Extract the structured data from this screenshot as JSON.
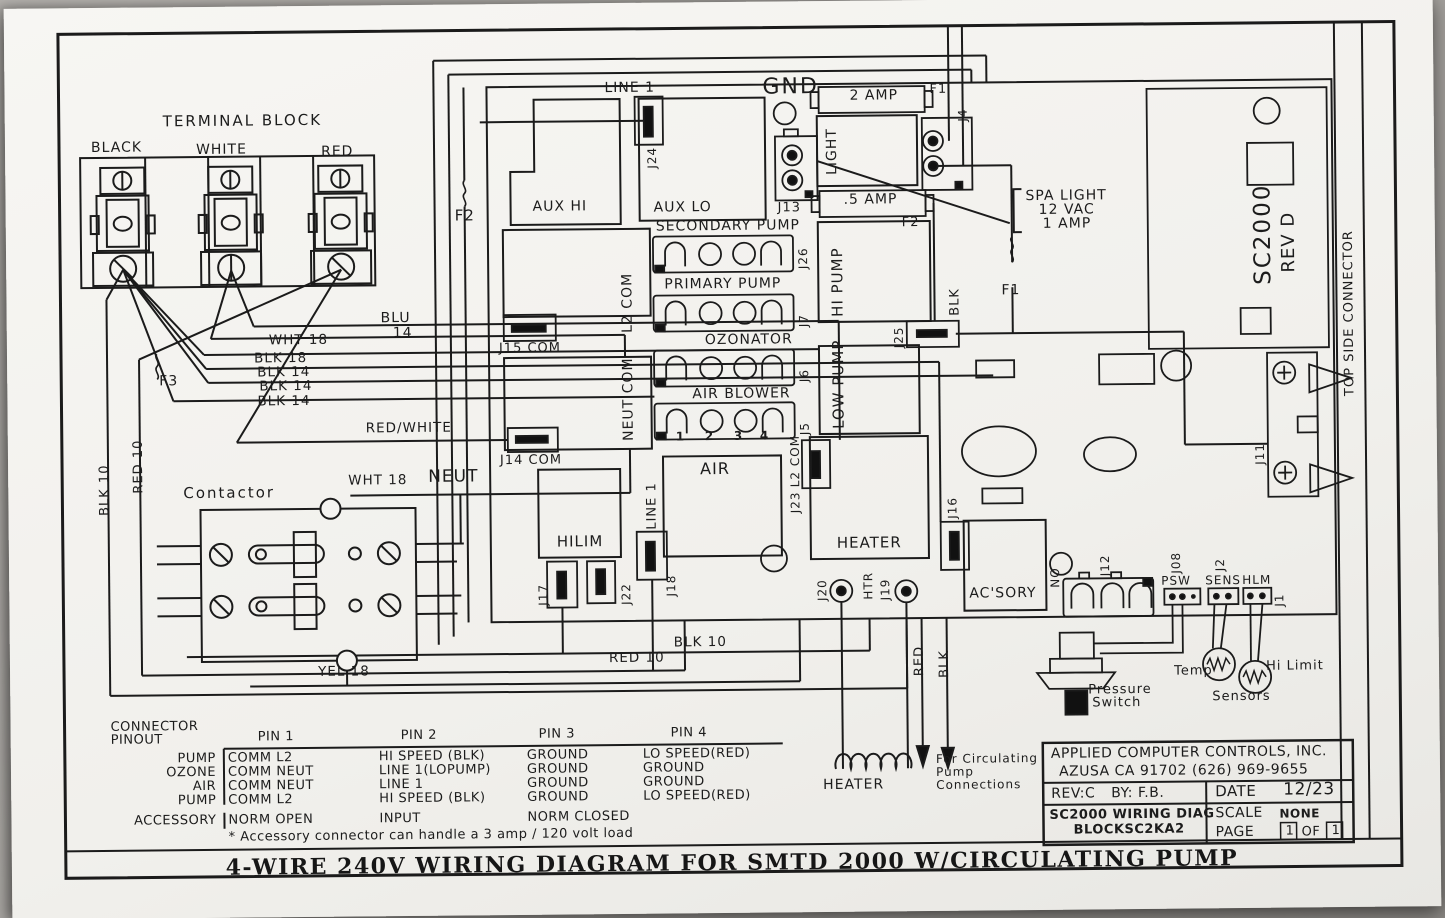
{
  "title_bar": "4-WIRE 240V WIRING DIAGRAM FOR SMTD 2000 W/CIRCULATING PUMP",
  "terminal_block": {
    "title": "TERMINAL BLOCK",
    "terminals": [
      "BLACK",
      "WHITE",
      "RED"
    ]
  },
  "board": {
    "gnd": "GND",
    "line1": "LINE 1",
    "j24": "J24",
    "aux_hi": "AUX HI",
    "aux_lo": "AUX LO",
    "f1": "F1",
    "f2": "F2",
    "f3": "F3",
    "fuse_2amp": "2 AMP",
    "fuse_half_amp": ".5 AMP",
    "j4": "J4",
    "light": "LIGHT",
    "j13": "J13",
    "spa_light_note": [
      "SPA LIGHT",
      "12 VAC",
      "1 AMP"
    ],
    "secondary_pump": "SECONDARY PUMP",
    "j26": "J26",
    "primary_pump": "PRIMARY PUMP",
    "j7": "J7",
    "ozonator": "OZONATOR",
    "j6": "J6",
    "air_blower": "AIR BLOWER",
    "j5": "J5",
    "pins": [
      "1",
      "2",
      "3",
      "4"
    ],
    "l2_com": "L2 COM",
    "j15_com": "J15 COM",
    "neut_com": "NEUT COM",
    "j14_com": "J14 COM",
    "hi_pump": "HI PUMP",
    "low_pump": "LOW PUMP",
    "j25": "J25",
    "sc2000": "SC2000",
    "rev_d": "REV D",
    "top_side_connector": "TOP SIDE CONNECTOR",
    "j11": "J11",
    "hilim": "HILIM",
    "j17": "J17",
    "j22": "J22",
    "j18": "J18",
    "air": "AIR",
    "j23": "J23",
    "heater": "HEATER",
    "j20": "J20",
    "htr": "HTR",
    "j19": "J19",
    "j16": "J16",
    "acsory": "AC'SORY",
    "no_label": "NO",
    "j12": "J12",
    "j08": "J08",
    "psw": "PSW",
    "j2": "J2",
    "sens": "SENS",
    "hlm": "HLM",
    "j1": "J1"
  },
  "wires": {
    "wht18": "WHT 18",
    "blk18": "BLK 18",
    "blk14": "BLK 14",
    "blu": "BLU",
    "blu_gauge": "14",
    "red_white": "RED/WHITE",
    "blk10": "BLK 10",
    "red10": "RED 10",
    "neut": "NEUT",
    "yel18": "YEL 18",
    "red": "RED",
    "blk": "BLK"
  },
  "contactor": {
    "label": "Contactor"
  },
  "sensors": {
    "pressure_switch": [
      "Pressure",
      "Switch"
    ],
    "temp": "Temp",
    "hi_limit": "Hi Limit",
    "sensors": "Sensors"
  },
  "bottom": {
    "heater_coil": "HEATER",
    "circulating_note": [
      "For Circulating",
      "Pump",
      "Connections"
    ]
  },
  "pinout": {
    "header": [
      "CONNECTOR",
      "PINOUT"
    ],
    "columns": [
      "PIN 1",
      "PIN 2",
      "PIN 3",
      "PIN 4"
    ],
    "rows": [
      {
        "name": "PUMP",
        "pins": [
          "COMM L2",
          "HI SPEED (BLK)",
          "GROUND",
          "LO SPEED(RED)"
        ]
      },
      {
        "name": "OZONE",
        "pins": [
          "COMM NEUT",
          "LINE 1(LOPUMP)",
          "GROUND",
          "GROUND"
        ]
      },
      {
        "name": "AIR",
        "pins": [
          "COMM NEUT",
          "LINE 1",
          "GROUND",
          "GROUND"
        ]
      },
      {
        "name": "PUMP",
        "pins": [
          "COMM L2",
          "HI SPEED (BLK)",
          "GROUND",
          "LO SPEED(RED)"
        ]
      },
      {
        "name": "ACCESSORY",
        "pins": [
          "NORM OPEN",
          "INPUT",
          "NORM CLOSED",
          ""
        ]
      }
    ],
    "footnote": "* Accessory connector can handle a 3 amp / 120 volt load"
  },
  "title_block": {
    "company": "APPLIED COMPUTER CONTROLS, INC.",
    "address": "AZUSA CA 91702 (626) 969-9655",
    "rev": "REV:C",
    "by": "BY: F.B.",
    "date_label": "DATE",
    "date": "12/23",
    "doc_line1": "SC2000 WIRING DIAG",
    "doc_line2": "BLOCKSC2KA2",
    "scale_label": "SCALE",
    "scale": "NONE",
    "page_label": "PAGE",
    "page_num": "1",
    "of_label": "OF",
    "page_total": "1"
  }
}
